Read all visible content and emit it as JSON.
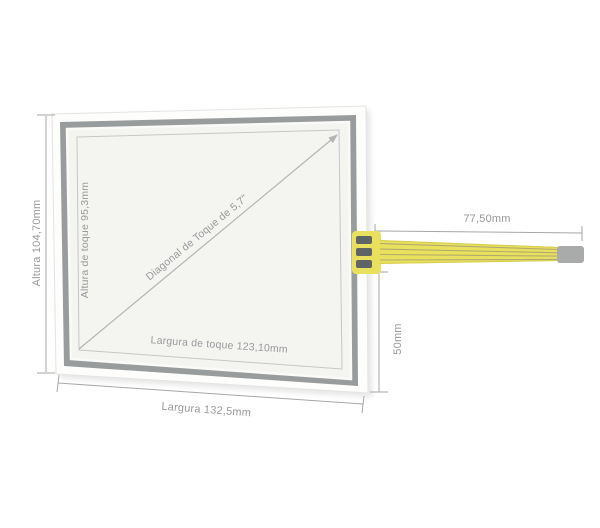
{
  "diagram": {
    "panel": {
      "height_total_label": "Altura 104,70mm",
      "height_touch_label": "Altura de toque 95,3mm",
      "diagonal_label": "Diagonal de Toque de 5,7\"",
      "width_touch_label": "Largura de toque 123,10mm",
      "width_total_label": "Largura 132,5mm"
    },
    "cable": {
      "length_label": "77,50mm",
      "offset_label": "50mm"
    },
    "colors": {
      "frame_gray": "#999c9c",
      "panel_inner": "#f4f4f1",
      "cable_yellow": "#e9e15e",
      "connector_gray": "#a9abab",
      "dimension_gray": "#a6a7a7",
      "label_gray": "#97999b"
    }
  }
}
